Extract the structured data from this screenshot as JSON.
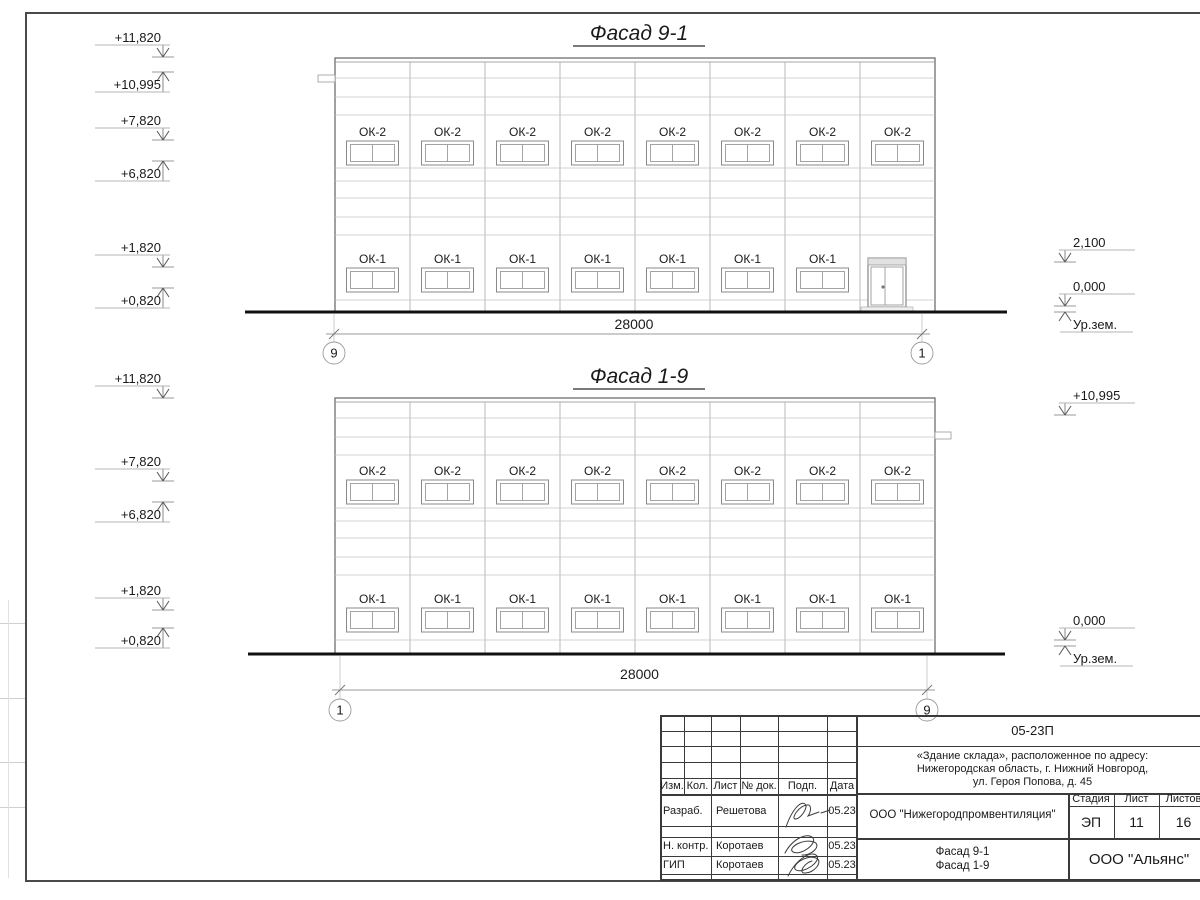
{
  "sheet": {
    "frame_color": "#4a4a4a",
    "line_color": "#8a8a8a",
    "siding_color": "#c4c4c4",
    "ground_color": "#111111",
    "text_color": "#1a1a1a"
  },
  "facades": [
    {
      "title": "Фасад 9-1",
      "dimension": "28000",
      "axes": [
        "9",
        "1"
      ],
      "window_rows": [
        {
          "mark": "ОК-2",
          "count": 8,
          "start_bay": 0
        },
        {
          "mark": "ОК-1",
          "count": 7,
          "start_bay": 0
        }
      ],
      "has_door": true,
      "elev_left": [
        {
          "label": "+11,820",
          "level": 57,
          "dir": "down"
        },
        {
          "label": "+10,995",
          "level": 72,
          "dir": "up"
        },
        {
          "label": "+7,820",
          "level": 140,
          "dir": "down"
        },
        {
          "label": "+6,820",
          "level": 161,
          "dir": "up"
        },
        {
          "label": "+1,820",
          "level": 267,
          "dir": "down"
        },
        {
          "label": "+0,820",
          "level": 288,
          "dir": "up"
        }
      ],
      "elev_right": [
        {
          "label": "2,100",
          "level": 262,
          "dir": "down"
        },
        {
          "label": "0,000",
          "level": 306,
          "dir": "down"
        },
        {
          "label": "Ур.зем.",
          "level": 312,
          "dir": "up",
          "ground": true
        }
      ],
      "layout": {
        "x": 335,
        "y": 58,
        "w": 600,
        "bays": 8,
        "title_cx": 639,
        "title_cy": 40,
        "title_w": 132,
        "hlines": [
          20,
          39,
          57,
          110,
          123,
          140,
          159,
          177,
          242
        ],
        "row_tops": [
          83,
          210
        ],
        "win_w": 52,
        "win_h": 24,
        "ground": {
          "y": 312,
          "x1": 245,
          "x2": 1007
        },
        "axes_x": [
          334,
          922
        ],
        "dim_y": 334,
        "dim_label_y": 329,
        "bubble_y": 353,
        "tab": {
          "side": "left",
          "rel_y": 17
        },
        "door": {
          "x1": 868,
          "x2": 906,
          "top": 258
        },
        "mark_x_left": 163,
        "mark_x_right": 1065
      }
    },
    {
      "title": "Фасад 1-9",
      "dimension": "28000",
      "axes": [
        "1",
        "9"
      ],
      "window_rows": [
        {
          "mark": "ОК-2",
          "count": 8,
          "start_bay": 0
        },
        {
          "mark": "ОК-1",
          "count": 8,
          "start_bay": 0
        }
      ],
      "has_door": false,
      "elev_left": [
        {
          "label": "+11,820",
          "level": 398,
          "dir": "down"
        },
        {
          "label": "+7,820",
          "level": 481,
          "dir": "down"
        },
        {
          "label": "+6,820",
          "level": 502,
          "dir": "up"
        },
        {
          "label": "+1,820",
          "level": 610,
          "dir": "down"
        },
        {
          "label": "+0,820",
          "level": 628,
          "dir": "up"
        }
      ],
      "elev_right": [
        {
          "label": "+10,995",
          "level": 415,
          "dir": "down"
        },
        {
          "label": "0,000",
          "level": 640,
          "dir": "down"
        },
        {
          "label": "Ур.зем.",
          "level": 646,
          "dir": "up",
          "ground": true
        }
      ],
      "layout": {
        "x": 335,
        "y": 398,
        "w": 600,
        "bays": 8,
        "title_cx": 639,
        "title_cy": 383,
        "title_w": 132,
        "hlines": [
          20,
          39,
          57,
          110,
          123,
          140,
          159,
          177,
          242
        ],
        "row_tops": [
          82,
          210
        ],
        "win_w": 52,
        "win_h": 24,
        "ground": {
          "y": 654,
          "x1": 248,
          "x2": 1005
        },
        "axes_x": [
          340,
          927
        ],
        "dim_y": 690,
        "dim_label_y": 679,
        "bubble_y": 710,
        "tab": {
          "side": "right",
          "rel_y": 34
        },
        "mark_x_left": 163,
        "mark_x_right": 1065
      }
    }
  ],
  "title_block": {
    "doc_number": "05-23П",
    "project_lines": [
      "«Здание склада», расположенное по адресу:",
      "Нижегородская область, г. Нижний Новгород,",
      "ул. Героя Попова, д. 45"
    ],
    "columns": [
      "Изм.",
      "Кол.",
      "Лист",
      "№ док.",
      "Подп.",
      "Дата"
    ],
    "rows": [
      {
        "role": "Разраб.",
        "name": "Решетова",
        "date": "05.23"
      },
      {
        "role": "Н. контр.",
        "name": "Коротаев",
        "date": "05.23"
      },
      {
        "role": "ГИП",
        "name": "Коротаев",
        "date": "05.23"
      }
    ],
    "org": "ООО \"Нижегородпромвентиляция\"",
    "stage_label": "Стадия",
    "stage": "ЭП",
    "sheet_label": "Лист",
    "sheet": "11",
    "sheets_label": "Листов",
    "sheets": "16",
    "drawing_title_lines": [
      "Фасад 9-1",
      "Фасад 1-9"
    ],
    "company": "ООО \"Альянс\""
  }
}
